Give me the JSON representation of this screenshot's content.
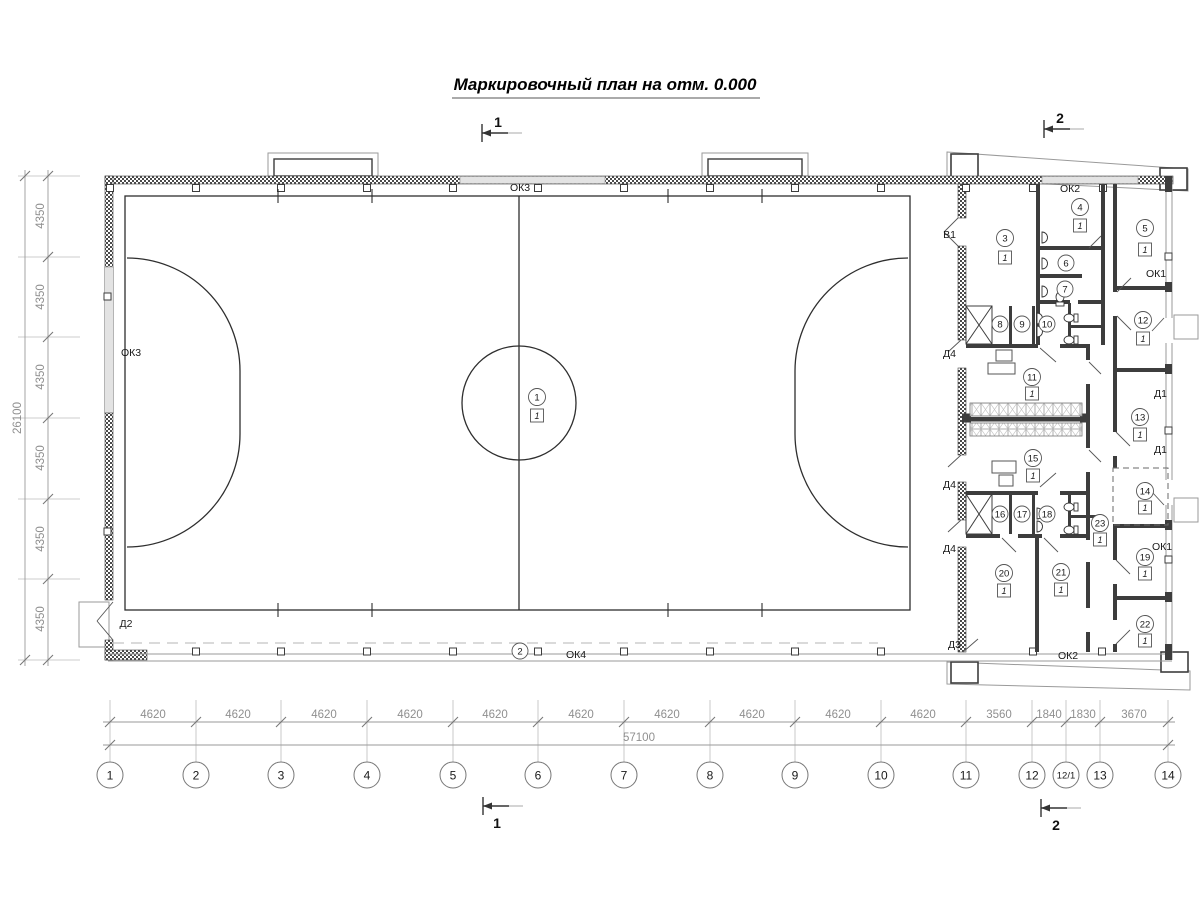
{
  "title": "Маркировочный план на отм. 0.000",
  "section_marks": {
    "s1": "1",
    "s2": "2"
  },
  "dimensions": {
    "left": {
      "segments": [
        "4350",
        "4350",
        "4350",
        "4350",
        "4350",
        "4350"
      ],
      "total": "26100"
    },
    "bottom": {
      "segments": [
        "4620",
        "4620",
        "4620",
        "4620",
        "4620",
        "4620",
        "4620",
        "4620",
        "4620",
        "4620",
        "3560",
        "1840",
        "1830",
        "3670"
      ],
      "total": "57100"
    }
  },
  "axes": [
    "1",
    "2",
    "3",
    "4",
    "5",
    "6",
    "7",
    "8",
    "9",
    "10",
    "11",
    "12",
    "12/1",
    "13",
    "14"
  ],
  "openings": {
    "window1": "ОК1",
    "window2": "ОК2",
    "window3": "ОК3",
    "window4": "ОК4",
    "gate1": "В1",
    "door1": "Д1",
    "door2": "Д2",
    "door3": "Д3",
    "door4": "Д4"
  },
  "rooms": {
    "r1": {
      "num": "1",
      "floor": "1"
    },
    "r2": {
      "num": "2"
    },
    "r3": {
      "num": "3",
      "floor": "1"
    },
    "r4": {
      "num": "4",
      "floor": "1"
    },
    "r5": {
      "num": "5",
      "floor": "1"
    },
    "r6": {
      "num": "6"
    },
    "r7": {
      "num": "7"
    },
    "r8": {
      "num": "8"
    },
    "r9": {
      "num": "9"
    },
    "r10": {
      "num": "10"
    },
    "r11": {
      "num": "11",
      "floor": "1"
    },
    "r12": {
      "num": "12",
      "floor": "1"
    },
    "r13": {
      "num": "13",
      "floor": "1"
    },
    "r14": {
      "num": "14",
      "floor": "1"
    },
    "r15": {
      "num": "15",
      "floor": "1"
    },
    "r16": {
      "num": "16"
    },
    "r17": {
      "num": "17"
    },
    "r18": {
      "num": "18"
    },
    "r19": {
      "num": "19",
      "floor": "1"
    },
    "r20": {
      "num": "20",
      "floor": "1"
    },
    "r21": {
      "num": "21",
      "floor": "1"
    },
    "r22": {
      "num": "22",
      "floor": "1"
    },
    "r23": {
      "num": "23",
      "floor": "1"
    }
  }
}
